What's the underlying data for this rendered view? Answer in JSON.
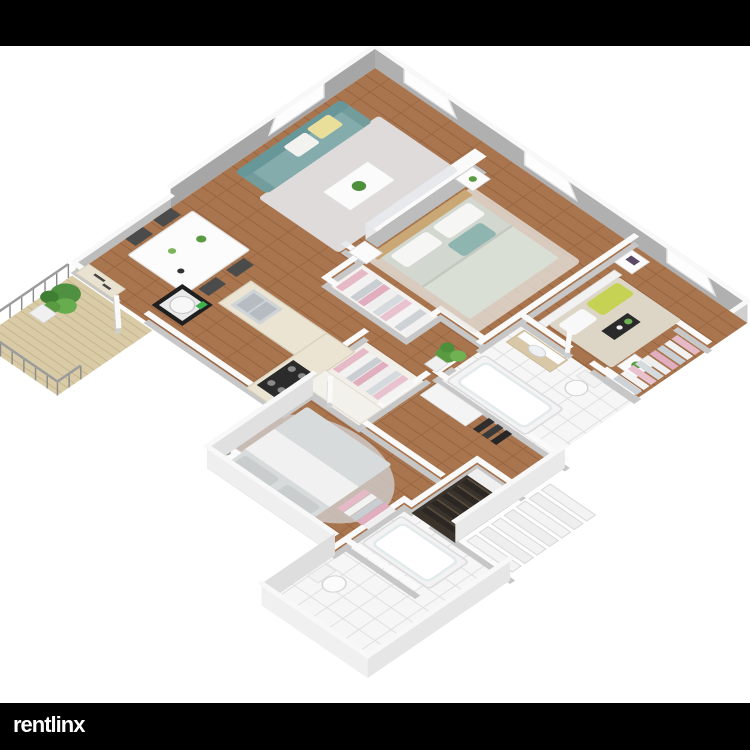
{
  "branding": {
    "logo_text": "rentlinx",
    "logo_color": "#ffffff",
    "letterbox_color": "#000000"
  },
  "scene": {
    "kind": "3d-isometric-floor-plan",
    "background": "#ffffff",
    "rooms": [
      {
        "id": "living-room",
        "items": [
          "teal-sofa",
          "yellow-pillow",
          "white-pillow",
          "area-rug",
          "coffee-table",
          "potted-plant",
          "tv-media-wall"
        ]
      },
      {
        "id": "dining-area",
        "items": [
          "white-dining-table",
          "four-dark-chairs",
          "counter-nook"
        ]
      },
      {
        "id": "kitchen",
        "items": [
          "l-shaped-counter",
          "sink",
          "gas-stove",
          "washer"
        ]
      },
      {
        "id": "hall-closet",
        "items": [
          "hanging-clothes",
          "linen-shelf"
        ]
      },
      {
        "id": "bedroom-1",
        "items": [
          "double-bed",
          "teal-pillows",
          "headboard",
          "two-nightstands",
          "open-closet",
          "rug",
          "plant"
        ]
      },
      {
        "id": "bedroom-2",
        "items": [
          "double-bed",
          "yellow-green-pillows",
          "nightstand",
          "flower-table",
          "walk-in-closet"
        ]
      },
      {
        "id": "bedroom-3",
        "items": [
          "double-bed",
          "fluffy-gray-rug",
          "two-nightstands",
          "closet"
        ]
      },
      {
        "id": "bathroom-1",
        "items": [
          "vanity-sink",
          "toilet",
          "bathtub",
          "tile-floor"
        ]
      },
      {
        "id": "bathroom-2",
        "items": [
          "bathtub",
          "toilet",
          "tile-floor"
        ]
      },
      {
        "id": "balcony",
        "items": [
          "wood-deck",
          "metal-railing",
          "large-plant"
        ]
      },
      {
        "id": "entry-hall",
        "items": [
          "shelving",
          "coat-hooks",
          "interior-stairs-dark",
          "exterior-stairs-white"
        ]
      }
    ],
    "colors": {
      "wall_face": "#b3b3b3",
      "wall_top": "#fafafa",
      "wood_floor": "#a9754e",
      "deck": "#d9cba6",
      "tile": "#f6f6f6",
      "sofa_teal": "#7aa2a3",
      "pillow_yellow": "#e9df9b",
      "pillow_green": "#c6d254",
      "clothes_pink": "#e5bac6",
      "stairs_dark": "#2c2722",
      "plant_green": "#5a9b42"
    }
  }
}
